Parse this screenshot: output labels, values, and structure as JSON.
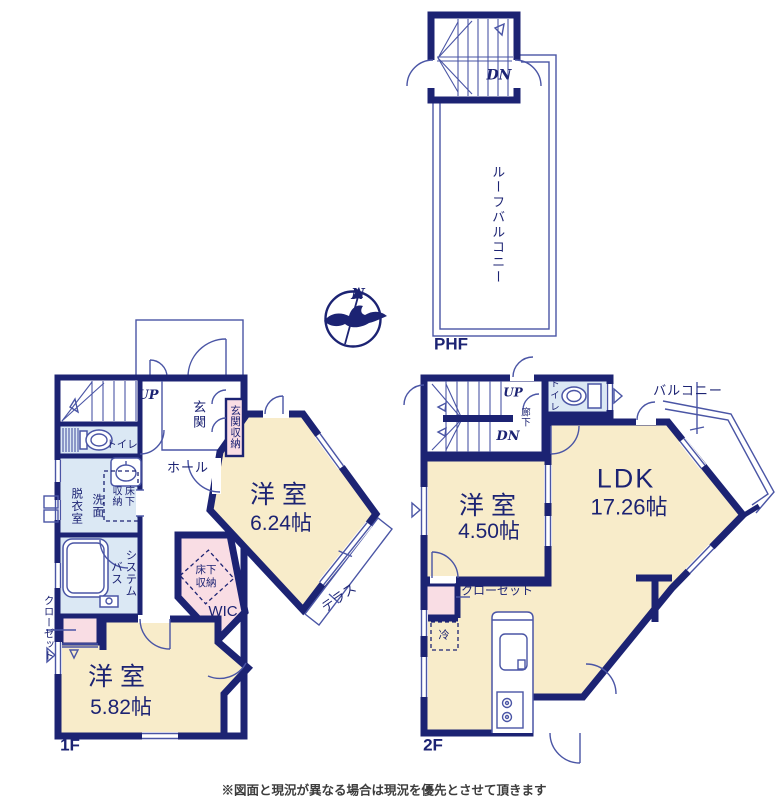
{
  "colors": {
    "wall_navy": "#1c2373",
    "thin_line": "#4a55a5",
    "room_cream": "#f8ecca",
    "storage_pink": "#f9dde4",
    "wet_blue": "#dbe8f4",
    "note_gray": "#3c3c3c"
  },
  "phf": {
    "dn": "DN",
    "roof_balcony": "ルーフバルコニー",
    "floor_label": "PHF"
  },
  "compass": {
    "north": "N"
  },
  "floor1": {
    "up": "UP",
    "entrance": "玄関",
    "entrance_storage": "玄関収納",
    "hall": "ホール",
    "toilet": "トイレ",
    "dressing_room": "脱衣室",
    "washstand": "洗面",
    "underfloor_storage": "床下\n収納",
    "system_bath": "システム\nバス",
    "closet": "クローゼット",
    "room_a_name": "洋室",
    "room_a_size": "6.24帖",
    "wic_underfloor_storage": "床下\n収納",
    "wic": "WIC",
    "terrace": "テラス",
    "room_b_name": "洋室",
    "room_b_size": "5.82帖",
    "floor_label": "1F"
  },
  "floor2": {
    "up": "UP",
    "dn": "DN",
    "corridor": "廊下",
    "toilet": "トイレ",
    "balcony": "バルコニー",
    "ldk_name": "LDK",
    "ldk_size": "17.26帖",
    "room_name": "洋室",
    "room_size": "4.50帖",
    "closet": "クローゼット",
    "refrigerator": "冷",
    "floor_label": "2F"
  },
  "note": "※図面と現況が異なる場合は現況を優先とさせて頂きます"
}
